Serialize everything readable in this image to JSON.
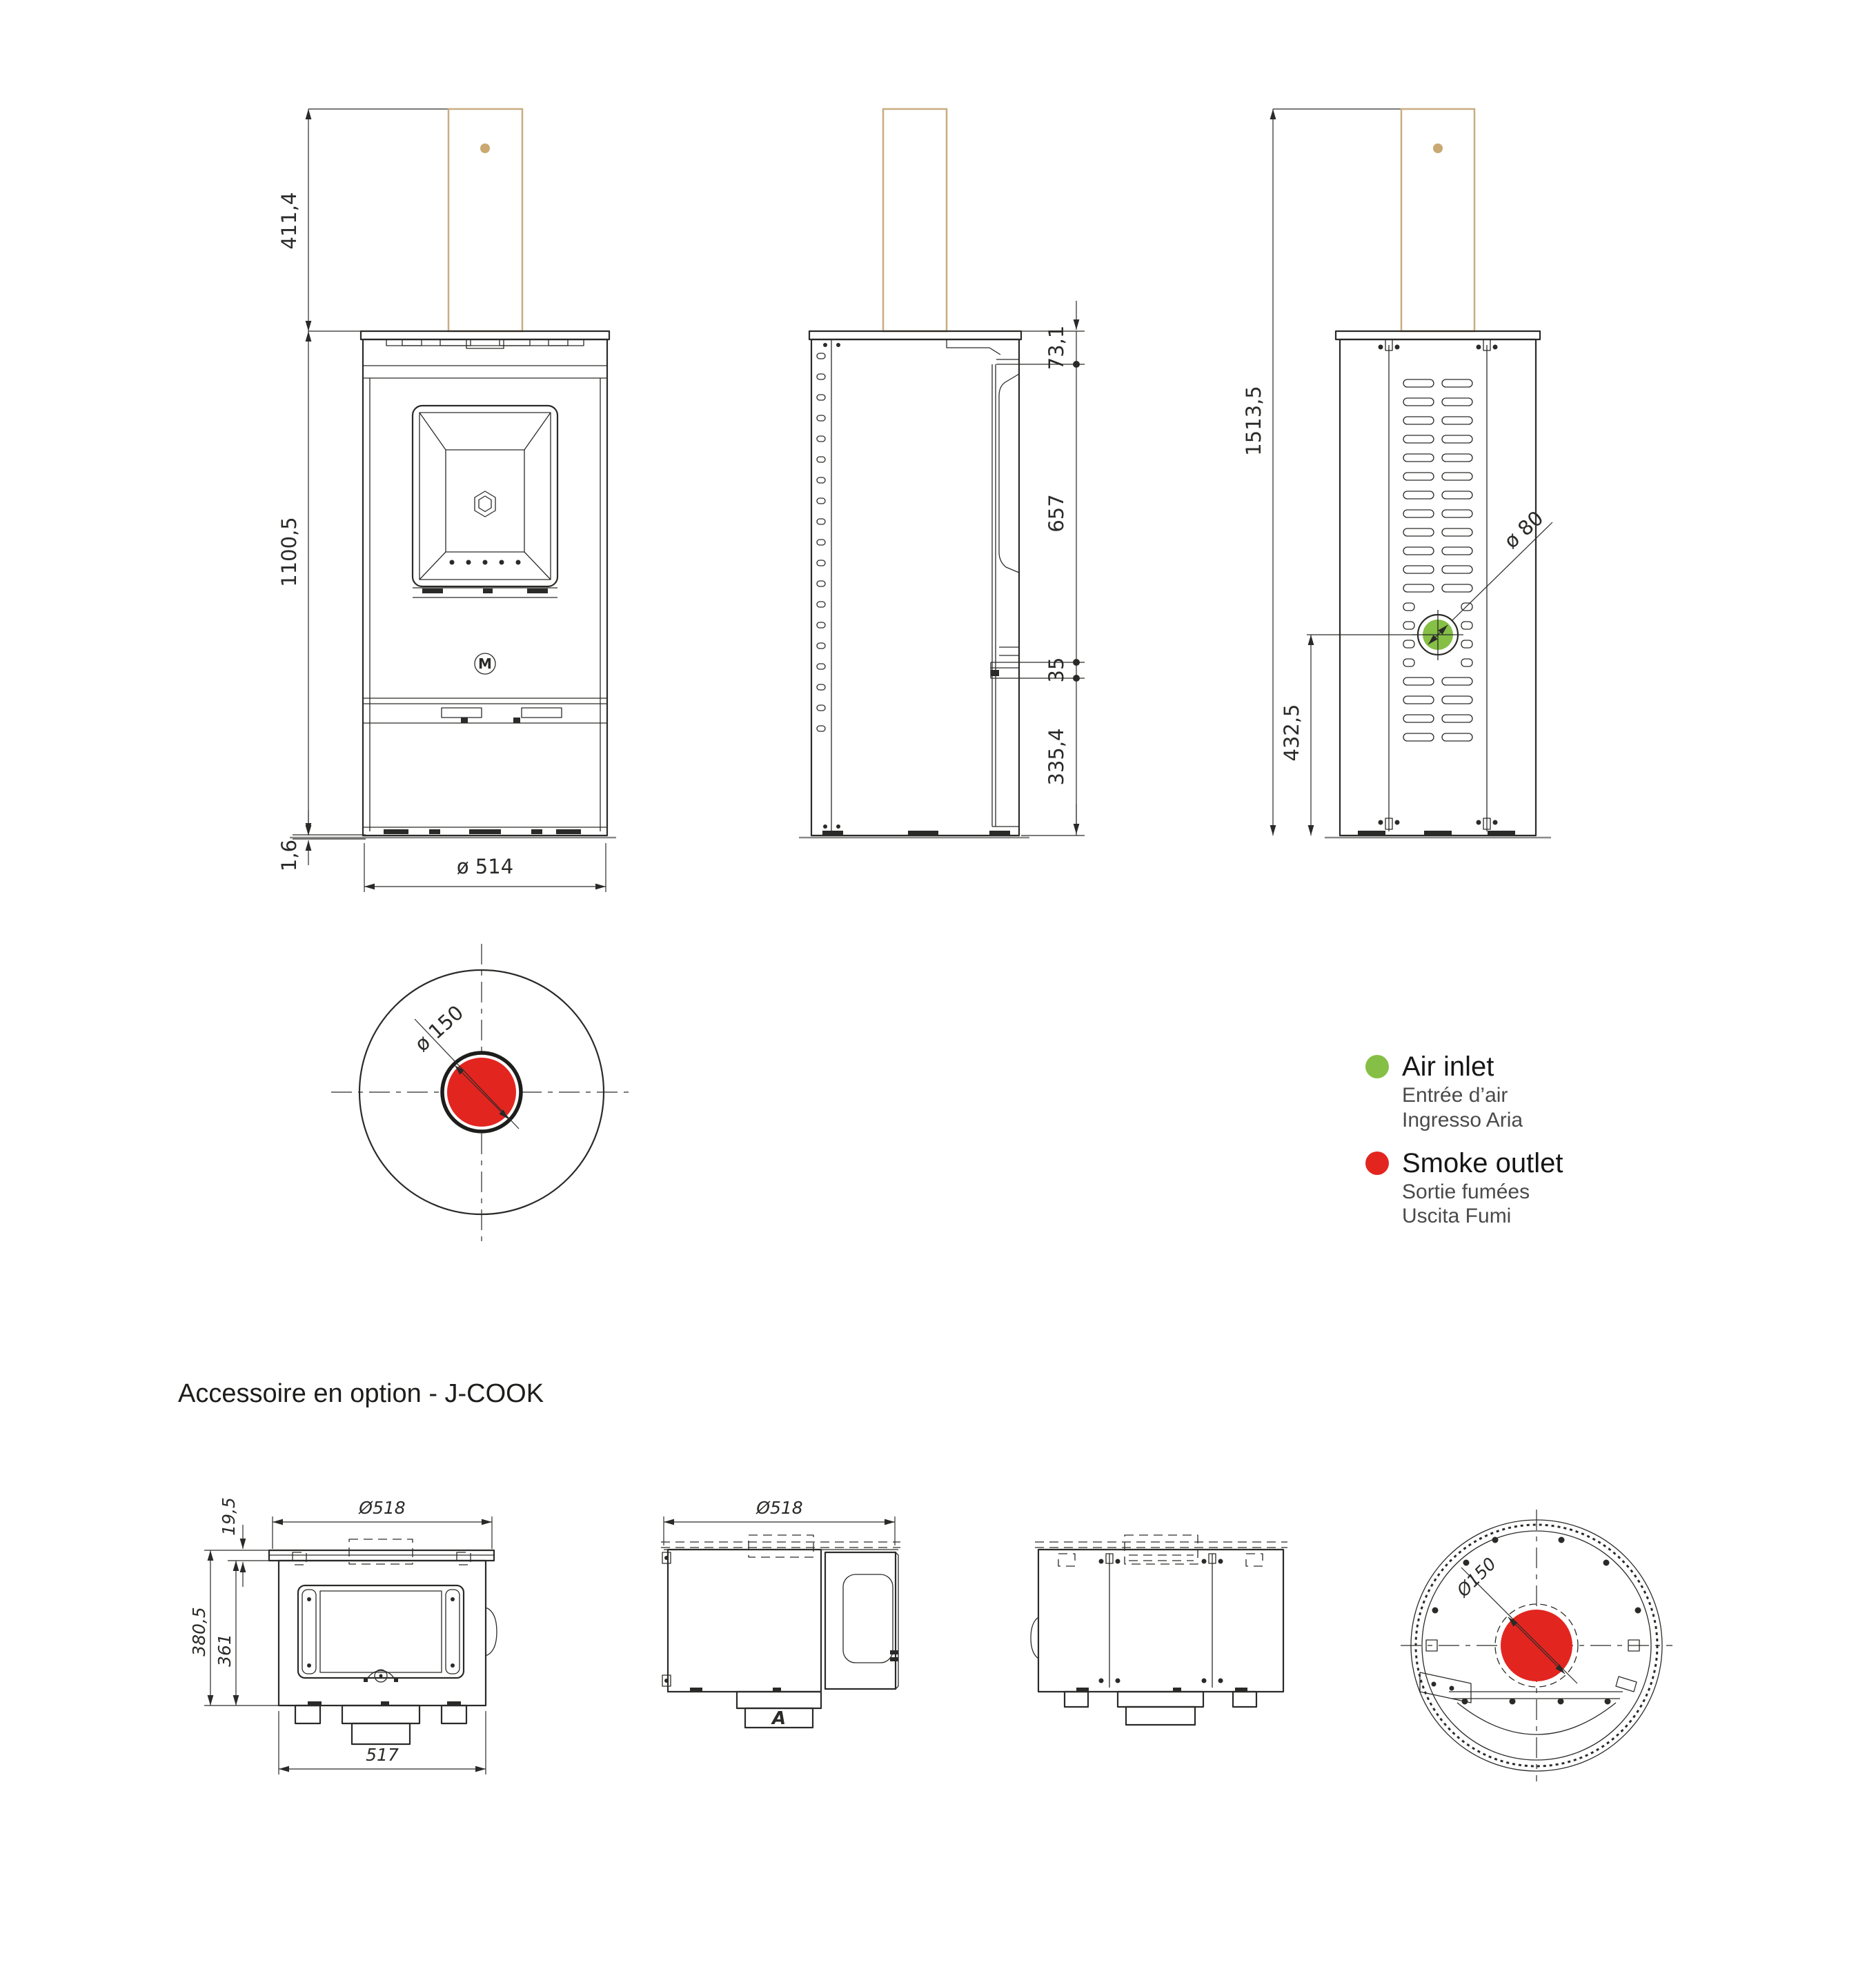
{
  "colors": {
    "line": "#2a2a28",
    "tan": "#c9ac80",
    "tan_dot": "#c9a871",
    "green": "#85bf45",
    "red": "#e32520"
  },
  "stove": {
    "front_view": {
      "dim_chimney_height": "411,4",
      "dim_body_height": "1100,5",
      "dim_base_thickness": "1,6",
      "dim_base_diameter": "ø 514",
      "brand_letter": "M"
    },
    "side_view": {
      "dim_top_section": "73,1",
      "dim_door_height": "657",
      "dim_lip_height": "35",
      "dim_lower_section": "335,4"
    },
    "back_view": {
      "dim_total_height": "1513,5",
      "dim_air_inlet_height": "432,5",
      "dim_air_inlet_diameter": "ø 80"
    },
    "top_view": {
      "dim_smoke_outlet_diameter": "ø 150"
    }
  },
  "legend": {
    "air_inlet": {
      "label": "Air inlet",
      "label_fr": "Entrée d’air",
      "label_it": "Ingresso Aria"
    },
    "smoke_outlet": {
      "label": "Smoke outlet",
      "label_fr": "Sortie fumées",
      "label_it": "Uscita Fumi"
    }
  },
  "accessory": {
    "heading": "Accessoire en option - J-COOK",
    "front_view": {
      "dim_top_diameter": "Ø518",
      "dim_plate_thickness": "19,5",
      "dim_total_height": "380,5",
      "dim_body_height": "361",
      "dim_width": "517"
    },
    "side_view": {
      "dim_top_diameter": "Ø518",
      "section_label": "A"
    },
    "top_view": {
      "dim_outlet_diameter": "Ø150"
    }
  }
}
